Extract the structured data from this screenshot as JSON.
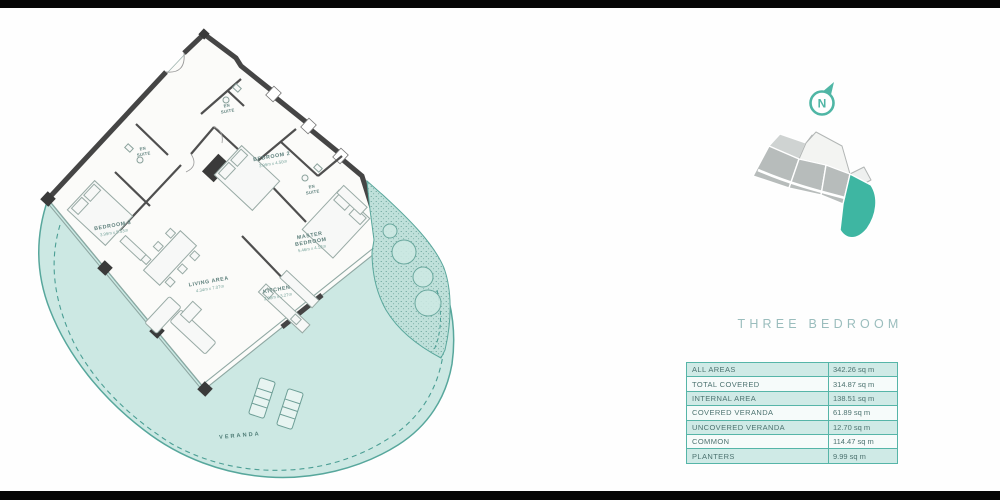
{
  "title": "THREE BEDROOM",
  "north": {
    "letter": "N",
    "icon": "north-compass-icon",
    "color": "#53b8a7"
  },
  "key_plan": {
    "highlighted_unit_color": "#3eb6a2",
    "building_color": "#b7bcbb"
  },
  "floor_plan": {
    "wall_color": "#454545",
    "veranda_fill": "#cce8e3",
    "outline_color": "#57a79c",
    "rooms": {
      "bedroom3": {
        "name": "BEDROOM 3",
        "dims": "3.99m x 5.53m"
      },
      "bedroom2": {
        "name": "BEDROOM 2",
        "dims": "3.99m x 4.50m"
      },
      "master": {
        "line1": "MASTER",
        "line2": "BEDROOM",
        "dims": "5.46m x 4.12m"
      },
      "living": {
        "name": "LIVING AREA",
        "dims": "4.34m x 7.07m"
      },
      "kitchen": {
        "name": "KITCHEN",
        "dims": "2.88m x 3.27m"
      },
      "ensuite": {
        "line1": "EN",
        "line2": "SUITE"
      },
      "veranda": {
        "name": "VERANDA"
      }
    }
  },
  "table": {
    "border_color": "#56b5a8",
    "row_fill": "#cfeae6",
    "rows": [
      {
        "label": "ALL AREAS",
        "value": "342.26 sq m"
      },
      {
        "label": "TOTAL COVERED",
        "value": "314.87 sq m"
      },
      {
        "label": "INTERNAL AREA",
        "value": "138.51 sq m"
      },
      {
        "label": "COVERED VERANDA",
        "value": "61.89 sq m"
      },
      {
        "label": "UNCOVERED VERANDA",
        "value": "12.70 sq m"
      },
      {
        "label": "COMMON",
        "value": "114.47 sq m"
      },
      {
        "label": "PLANTERS",
        "value": "9.99 sq m"
      }
    ]
  }
}
